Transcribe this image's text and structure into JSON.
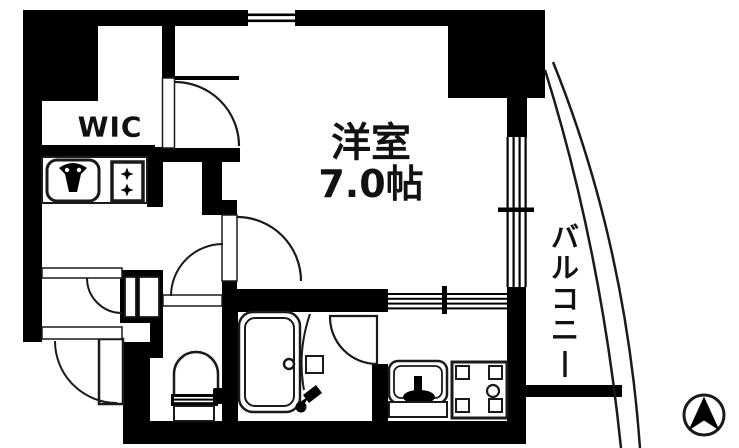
{
  "canvas": {
    "width": 739,
    "height": 448,
    "background": "#ffffff"
  },
  "palette": {
    "wall": "#000000",
    "floor": "#ffffff",
    "line": "#1a1a1a"
  },
  "labels": {
    "walk_in_closet": "WIC",
    "main_room_name": "洋室",
    "main_room_size": "7.0帖",
    "balcony": "バルコニー"
  },
  "icons": {
    "kitchen_sink": "sink-with-faucet-icon",
    "stove": "two-burner-stove-icon",
    "toilet": "toilet-icon",
    "bathtub": "bathtub-icon",
    "shower_faucet": "shower-faucet-icon",
    "washbasin": "washbasin-icon",
    "washing_machine": "washing-machine-pan-icon",
    "compass": "north-arrow-icon",
    "doors": "door-swing-arc",
    "windows": "sliding-window-lines"
  }
}
